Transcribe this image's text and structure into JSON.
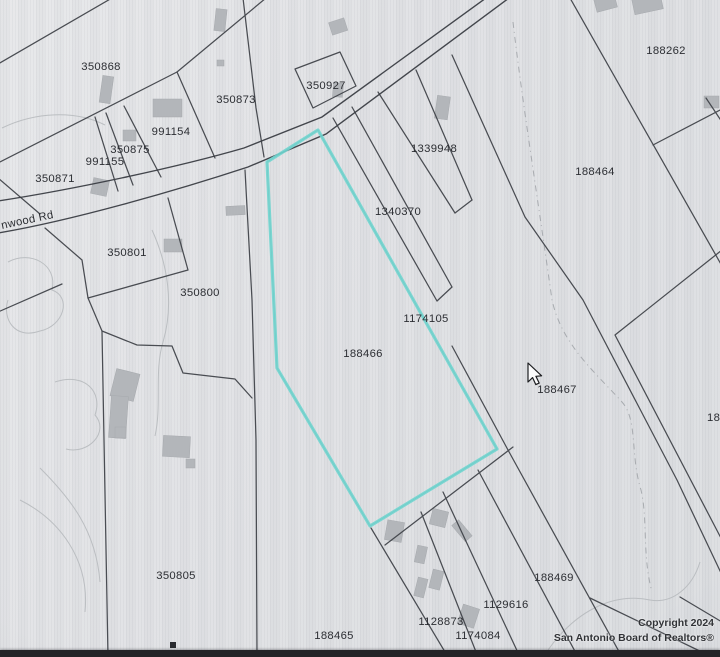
{
  "map": {
    "road_label": "nwood  Rd",
    "highlighted_parcel": "188466",
    "highlight_color": "#70d5cf",
    "parcels": [
      {
        "label": "350868"
      },
      {
        "label": "350873"
      },
      {
        "label": "350927"
      },
      {
        "label": "188262"
      },
      {
        "label": "991154"
      },
      {
        "label": "350875"
      },
      {
        "label": "991155"
      },
      {
        "label": "1339948"
      },
      {
        "label": "188464"
      },
      {
        "label": "350871"
      },
      {
        "label": "1340370"
      },
      {
        "label": "350801"
      },
      {
        "label": "350800"
      },
      {
        "label": "1174105"
      },
      {
        "label": "188466"
      },
      {
        "label": "188467"
      },
      {
        "label": "1884"
      },
      {
        "label": "350805"
      },
      {
        "label": "188469"
      },
      {
        "label": "1129616"
      },
      {
        "label": "1128873"
      },
      {
        "label": "188465"
      },
      {
        "label": "1174084"
      }
    ],
    "copyright": {
      "line1": "Copyright 2024",
      "line2": "San Antonio Board of Realtors®"
    }
  }
}
